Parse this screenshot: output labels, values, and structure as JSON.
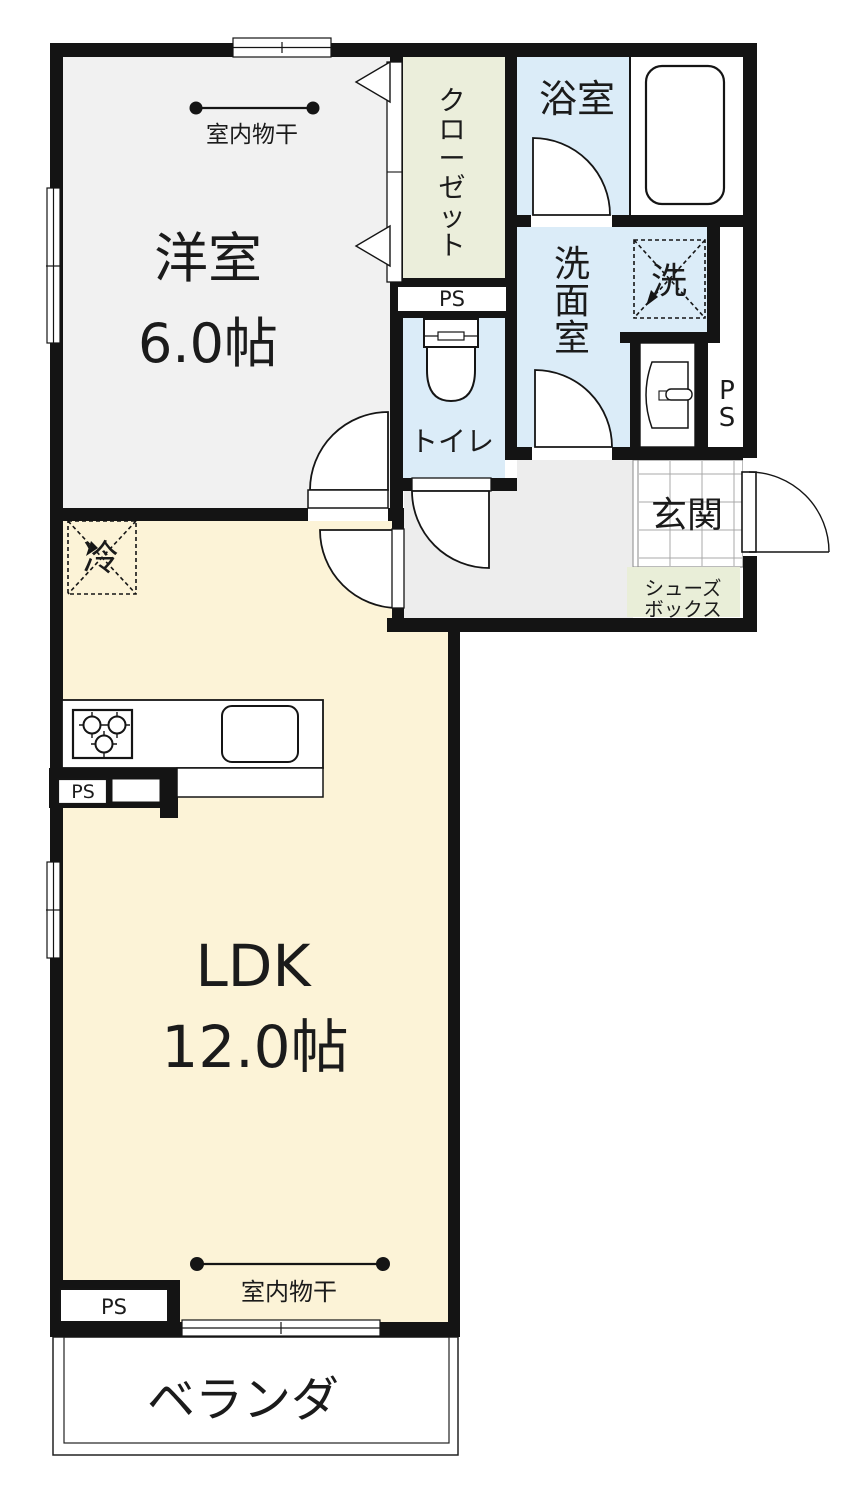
{
  "plan": {
    "rooms": {
      "bedroom": {
        "name": "洋室",
        "size": "6.0帖"
      },
      "ldk": {
        "name": "LDK",
        "size": "12.0帖"
      },
      "bath": {
        "name": "浴室"
      },
      "washroom": {
        "name": "洗面室",
        "chars": [
          "洗",
          "面",
          "室"
        ]
      },
      "toilet": {
        "name": "トイレ"
      },
      "entrance": {
        "name": "玄関"
      },
      "closet": {
        "name": "クローゼット",
        "chars": [
          "ク",
          "ロ",
          "ー",
          "ゼ",
          "ッ",
          "ト"
        ]
      },
      "shoebox": {
        "line1": "シューズ",
        "line2": "ボックス"
      },
      "veranda": {
        "name": "ベランダ"
      }
    },
    "labels": {
      "drying": "室内物干",
      "ps": "PS",
      "ps_p": "P",
      "ps_s": "S",
      "washer": "洗",
      "fridge": "冷"
    },
    "colors": {
      "wall": "#141414",
      "bedroom_floor": "#f1f1f1",
      "ldk_floor": "#fcf3d7",
      "wet_floor": "#dbecf8",
      "closet_fill": "#ebeedb",
      "shoebox_fill": "#e9eed8",
      "hall_floor": "#ededed",
      "white": "#ffffff",
      "entrance_text": "#493c33",
      "line": "#1b1b1b"
    }
  }
}
